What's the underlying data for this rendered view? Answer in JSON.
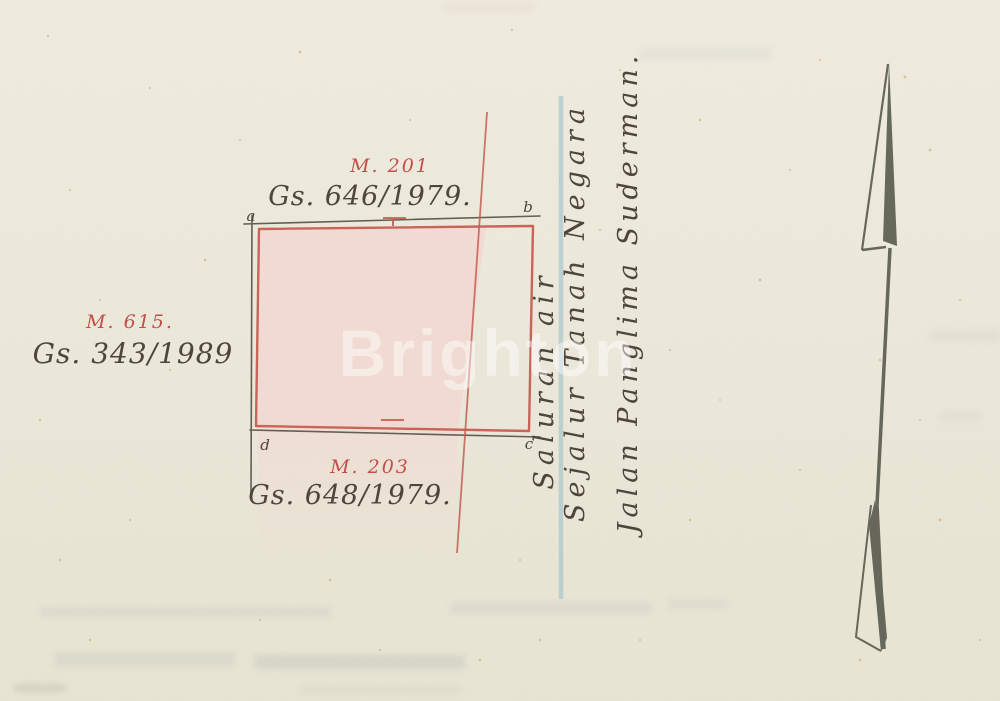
{
  "watermark": {
    "text": "Brighton"
  },
  "parcels": {
    "north": {
      "number": "M. 201",
      "reference": "Gs. 646/1979."
    },
    "west": {
      "number": "M. 615.",
      "reference": "Gs. 343/1989"
    },
    "south": {
      "number": "M. 203",
      "reference": "Gs. 648/1979."
    }
  },
  "corner_letters": {
    "top_left": "a",
    "top_right": "b",
    "bottom_right": "c",
    "bottom_left": "d"
  },
  "boundary_labels": {
    "water_channel": "Saluran air",
    "state_land_strip": "Sejalur Tanah Negara",
    "road": "Jalan Panglima Suderman."
  },
  "colors": {
    "paper": "#EDE9DC",
    "plot_fill": "#F2D8D1",
    "boundary_red": "#C5574C",
    "water_blue": "#A9C6CB",
    "ink_dark": "#4E463B",
    "ink_red": "#C24F4A",
    "arrow_gray": "#5B5D50"
  }
}
